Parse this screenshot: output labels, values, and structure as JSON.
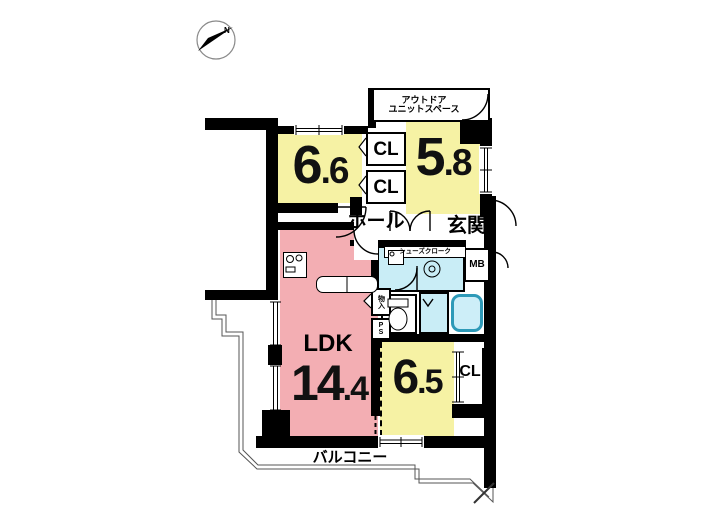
{
  "title": "マンション間取り図",
  "colors": {
    "room_yellow": "#f6f2a4",
    "ldk_pink": "#f3aeb3",
    "wet_cyan": "#c9edf6",
    "tub_border": "#2e9ab8",
    "wall_black": "#000000"
  },
  "compass": {
    "north_label": "N"
  },
  "labels": {
    "outdoor_line1": "アウトドア",
    "outdoor_line2": "ユニットスペース",
    "hall": "ホール",
    "entrance": "玄関",
    "shoes_closet": "シューズクローク",
    "meter_box": "MB",
    "closet_a": "CL",
    "closet_b": "CL",
    "closet_c": "CL",
    "storage": "物入",
    "pipe_space": "PS",
    "balcony": "バルコニー",
    "ldk": "LDK"
  },
  "room_sizes": {
    "bedroom_a": {
      "int": "6",
      "dec": ".6"
    },
    "bedroom_b": {
      "int": "5",
      "dec": ".8"
    },
    "ldk": {
      "int": "14",
      "dec": ".4"
    },
    "bedroom_c": {
      "int": "6",
      "dec": ".5"
    }
  }
}
